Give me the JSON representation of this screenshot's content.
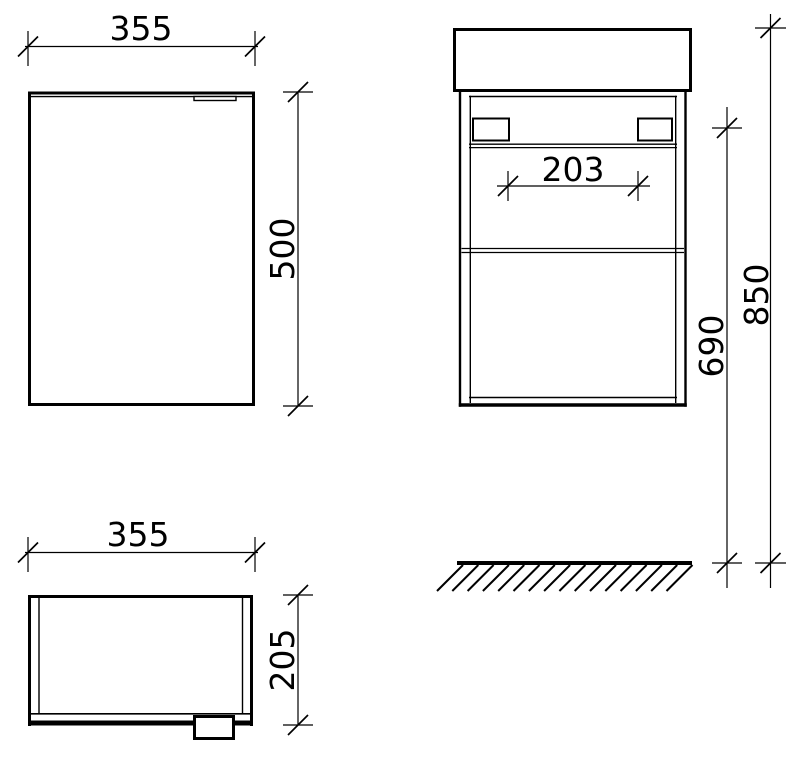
{
  "drawing": {
    "type": "technical-dimension-drawing",
    "subject": "wall-hung vanity cabinet with basin",
    "background": "#ffffff",
    "line_color": "#000000",
    "units": "mm",
    "views": {
      "front": {
        "width": "355",
        "height": "500"
      },
      "plan": {
        "width": "355",
        "depth": "205"
      },
      "side": {
        "opening_width": "203",
        "underside_height": "690",
        "overall_height": "850"
      }
    }
  }
}
